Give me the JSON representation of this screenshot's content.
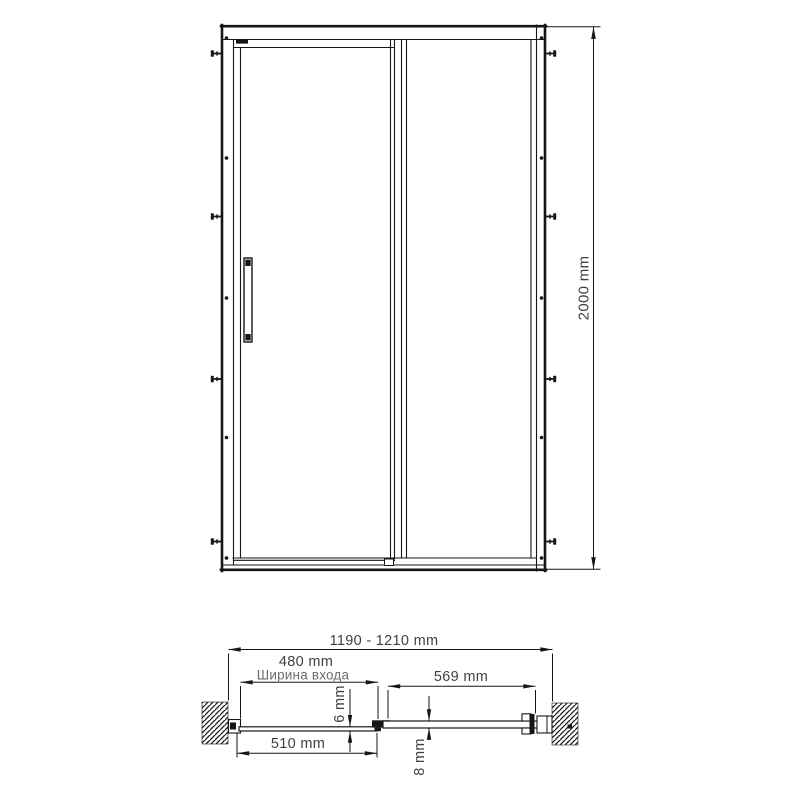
{
  "labels": {
    "height": "2000 mm",
    "overall_width": "1190 - 1210 mm",
    "entrance_width": "480 mm",
    "entrance_caption": "Ширина входа",
    "fixed_panel_width": "569 mm",
    "door_panel_width": "510 mm",
    "door_glass_thickness": "6 mm",
    "fixed_glass_thickness": "8 mm"
  },
  "colors": {
    "line": "#161616",
    "dim_text": "#3f3f3f",
    "caption_text": "#6e6e6e",
    "background": "#ffffff"
  }
}
